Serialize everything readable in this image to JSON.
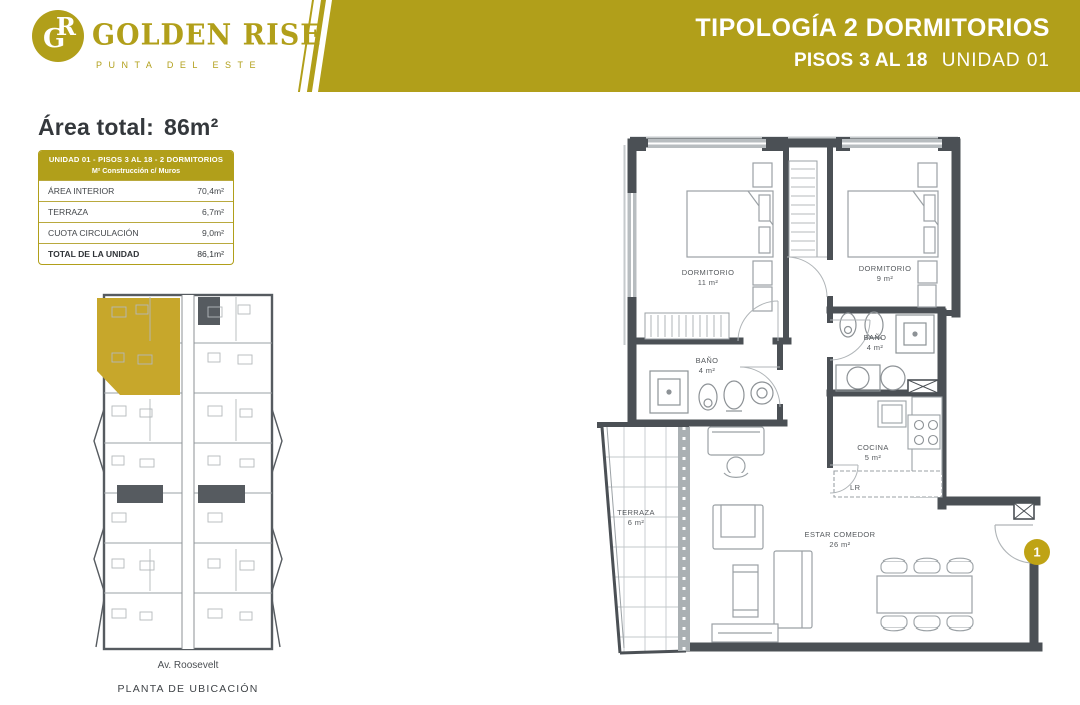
{
  "brand": {
    "monogram_g": "G",
    "monogram_r": "R",
    "name": "GOLDEN RISE",
    "location": "PUNTA DEL ESTE"
  },
  "header": {
    "title": "TIPOLOGÍA 2 DORMITORIOS",
    "pisos": "PISOS 3 AL 18",
    "unidad": "UNIDAD 01"
  },
  "summary": {
    "label": "Área total:",
    "value": "86m²"
  },
  "table": {
    "header_line1": "UNIDAD 01 - PISOS 3 AL 18 - 2 DORMITORIOS",
    "header_line2": "M² Construcción c/ Muros",
    "rows": [
      {
        "label": "ÁREA INTERIOR",
        "value": "70,4m²"
      },
      {
        "label": "TERRAZA",
        "value": "6,7m²"
      },
      {
        "label": "CUOTA CIRCULACIÓN",
        "value": "9,0m²"
      }
    ],
    "total_label": "TOTAL DE LA UNIDAD",
    "total_value": "86,1m²"
  },
  "location_plan": {
    "street": "Av. Roosevelt",
    "caption": "PLANTA DE UBICACIÓN"
  },
  "floor_plan": {
    "rooms": [
      {
        "name": "DORMITORIO",
        "area": "11 m²"
      },
      {
        "name": "DORMITORIO",
        "area": "9 m²"
      },
      {
        "name": "BAÑO",
        "area": "4 m²"
      },
      {
        "name": "BAÑO",
        "area": "4 m²"
      },
      {
        "name": "COCINA",
        "area": "5 m²"
      },
      {
        "name": "ESTAR COMEDOR",
        "area": "26 m²"
      },
      {
        "name": "TERRAZA",
        "area": "6 m²"
      }
    ],
    "appliance_label": "LR",
    "unit_badge": "1"
  },
  "colors": {
    "gold": "#b19f1a",
    "gold_highlight": "#c7a72b",
    "badge_gold": "#bfa315",
    "wall": "#4b5055",
    "ink": "#34383c"
  }
}
